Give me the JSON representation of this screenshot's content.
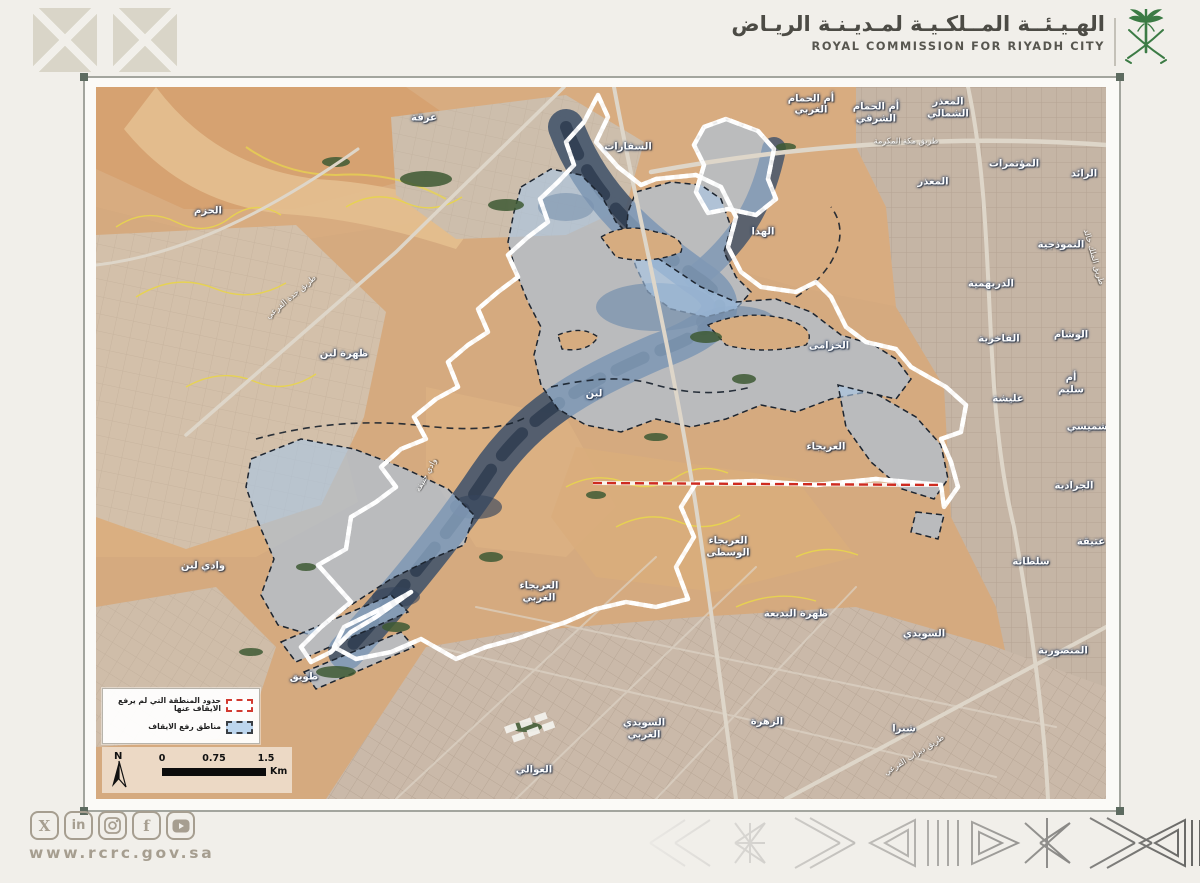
{
  "header": {
    "title_ar": "الهـيـئــة المــلكـيـة لمـديـنـة الريـاض",
    "title_en": "ROYAL COMMISSION FOR RIYADH CITY",
    "emblem": "saudi-palm-and-swords",
    "emblem_color": "#3c7b45"
  },
  "footer": {
    "website": "www.rcrc.gov.sa",
    "social_icons": [
      "x-twitter",
      "linkedin",
      "instagram",
      "facebook",
      "youtube"
    ],
    "icon_color": "#a69e90"
  },
  "map": {
    "legend": {
      "items": [
        {
          "swatch": "red-dashed-outline",
          "label": "حدود المنطقة التي لم يرفع الايقاف عنها"
        },
        {
          "swatch": "blue-fill-dashed",
          "label": "مناطق رفع الايقاف"
        }
      ]
    },
    "north_label": "N",
    "scale": {
      "ticks": [
        "0",
        "0.75",
        "1.5"
      ],
      "unit": "Km"
    },
    "colors": {
      "boundary_red": "#ce2b20",
      "lifted_blue": "#a9c6e6",
      "wadi_dark": "#44546a",
      "sand": "#d5ab80",
      "contour_yellow": "#e8d44f",
      "vegetation_green": "#3e5a34"
    },
    "labels": [
      {
        "text": "عرقة",
        "x": 328,
        "y": 31
      },
      {
        "text": "السفارات",
        "x": 532,
        "y": 60
      },
      {
        "text": "أم الحمام\nالغربي",
        "x": 715,
        "y": 18
      },
      {
        "text": "أم الحمام\nالشرقي",
        "x": 780,
        "y": 26
      },
      {
        "text": "المعذر\nالشمالي",
        "x": 852,
        "y": 21
      },
      {
        "text": "المعذر",
        "x": 837,
        "y": 95
      },
      {
        "text": "المؤتمرات",
        "x": 918,
        "y": 77
      },
      {
        "text": "الرائد",
        "x": 988,
        "y": 87
      },
      {
        "text": "الهدا",
        "x": 667,
        "y": 145
      },
      {
        "text": "الخزامى",
        "x": 733,
        "y": 259
      },
      {
        "text": "النموذجية",
        "x": 965,
        "y": 158
      },
      {
        "text": "الدريهمية",
        "x": 895,
        "y": 197
      },
      {
        "text": "الفاخرية",
        "x": 903,
        "y": 252
      },
      {
        "text": "الوشام",
        "x": 975,
        "y": 248
      },
      {
        "text": "أم سليم",
        "x": 975,
        "y": 297
      },
      {
        "text": "عليشة",
        "x": 912,
        "y": 312
      },
      {
        "text": "الشميسي",
        "x": 995,
        "y": 340
      },
      {
        "text": "الجرادية",
        "x": 978,
        "y": 399
      },
      {
        "text": "عتيقة",
        "x": 995,
        "y": 455
      },
      {
        "text": "سلطانة",
        "x": 935,
        "y": 475
      },
      {
        "text": "المنصورية",
        "x": 967,
        "y": 564
      },
      {
        "text": "الحزم",
        "x": 112,
        "y": 124
      },
      {
        "text": "ظهرة لبن",
        "x": 248,
        "y": 267
      },
      {
        "text": "لبن",
        "x": 498,
        "y": 307
      },
      {
        "text": "وادي لبن",
        "x": 107,
        "y": 479
      },
      {
        "text": "طويق",
        "x": 208,
        "y": 590
      },
      {
        "text": "العوالي",
        "x": 438,
        "y": 683
      },
      {
        "text": "العريجاء",
        "x": 730,
        "y": 360
      },
      {
        "text": "العريجاء\nالوسطى",
        "x": 632,
        "y": 460
      },
      {
        "text": "العريجاء\nالغربي",
        "x": 443,
        "y": 505
      },
      {
        "text": "ظهرة البديعة",
        "x": 700,
        "y": 527
      },
      {
        "text": "السويدي\nالغربي",
        "x": 548,
        "y": 642
      },
      {
        "text": "السويدي",
        "x": 828,
        "y": 547
      },
      {
        "text": "الزهرة",
        "x": 671,
        "y": 635
      },
      {
        "text": "شبرا",
        "x": 808,
        "y": 642
      },
      {
        "text": "طريق مكة المكرمة",
        "x": 810,
        "y": 54,
        "kind": "road"
      },
      {
        "text": "طريق جدة الفرعي",
        "x": 195,
        "y": 210,
        "rot": -40,
        "kind": "road"
      },
      {
        "text": "وادي حنيفة",
        "x": 330,
        "y": 388,
        "rot": -62,
        "kind": "road"
      },
      {
        "text": "طريق الملك خالد",
        "x": 998,
        "y": 170,
        "rot": 74,
        "kind": "road"
      },
      {
        "text": "طريق ديراب الفرعي",
        "x": 818,
        "y": 668,
        "rot": -32,
        "kind": "road"
      }
    ]
  }
}
